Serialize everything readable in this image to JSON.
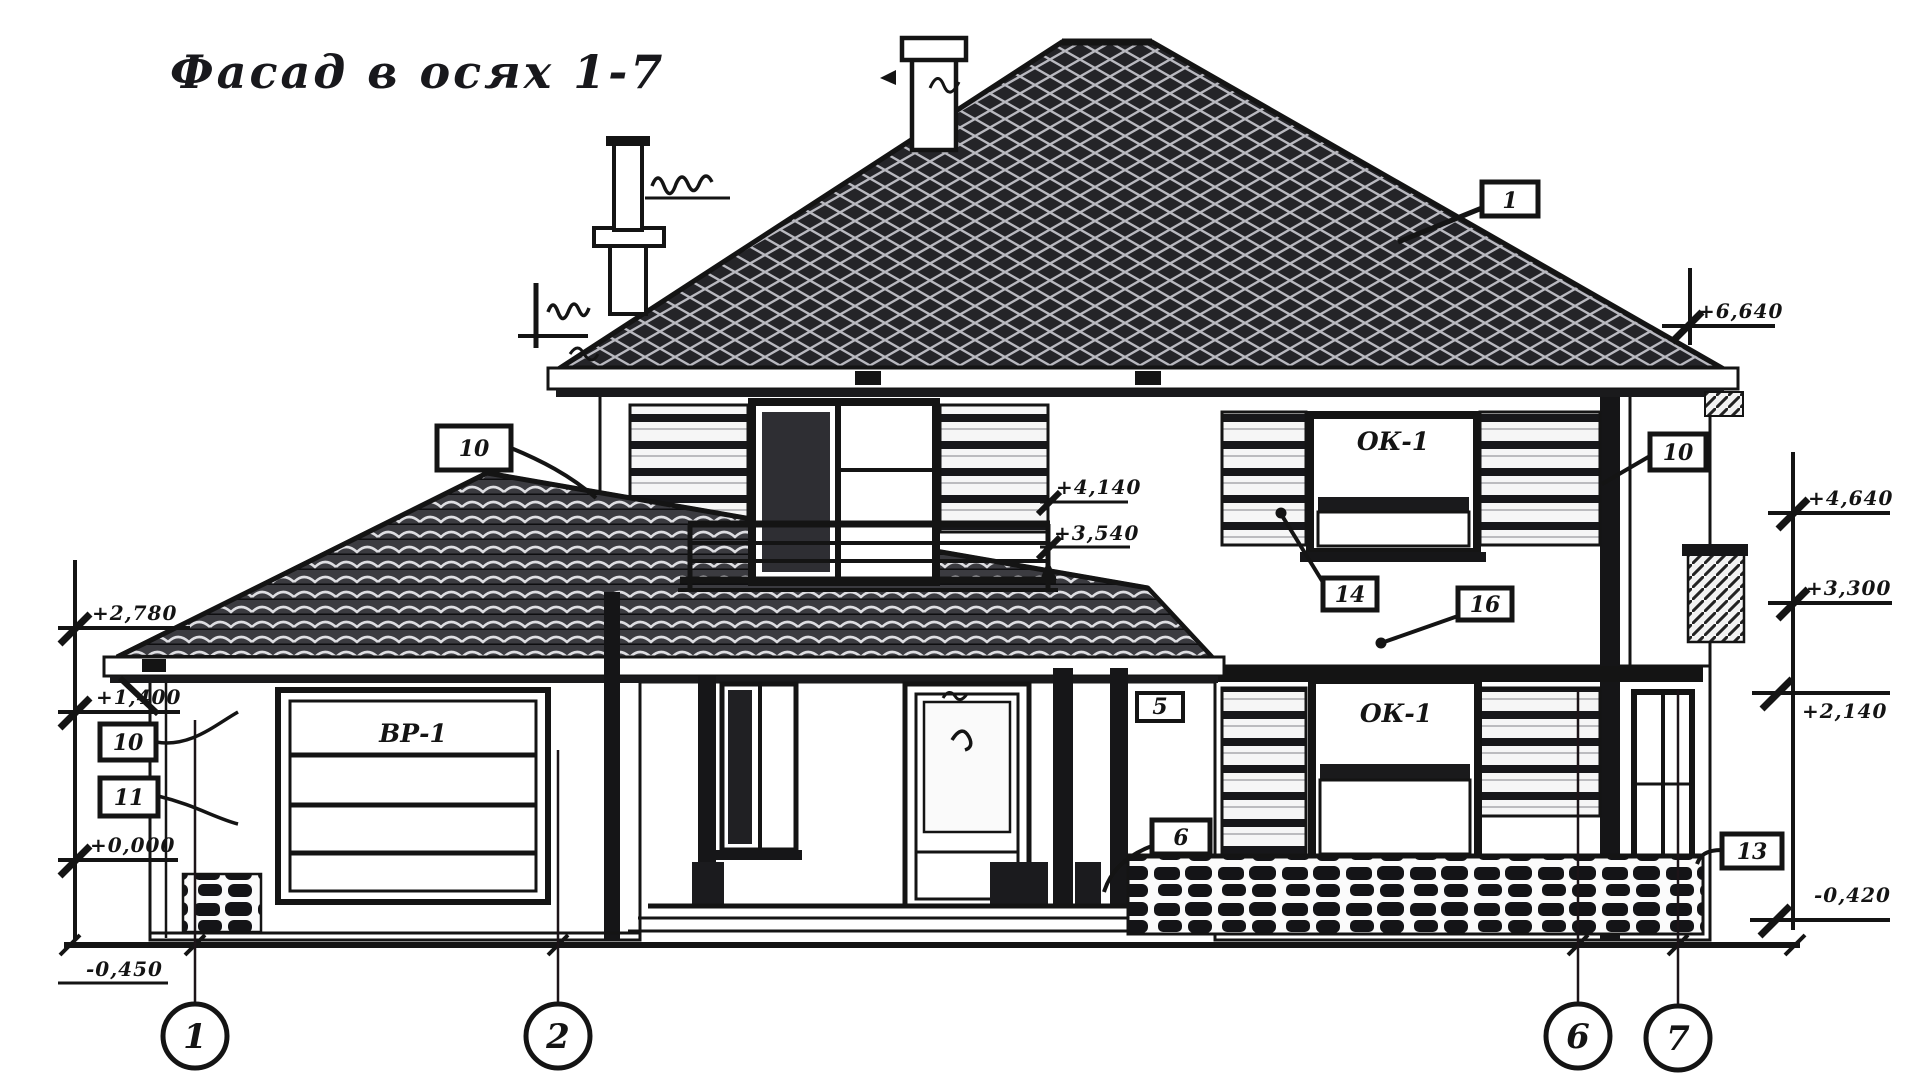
{
  "title": "Фасад в осях 1-7",
  "axis_markers": [
    "1",
    "2",
    "6",
    "7"
  ],
  "window_labels": {
    "second_floor_right": "ОК-1",
    "first_floor_right": "ОК-1"
  },
  "garage_door_label": "ВР-1",
  "callouts": {
    "roof": "1",
    "lower_roof": "10",
    "right_upper": "10",
    "left_upper": "10",
    "left_lower": "11",
    "mid_upper": "14",
    "mid_lower": "16",
    "porch_beam": "5",
    "stone_base": "6",
    "right_corner": "13"
  },
  "elevations": {
    "left": [
      "+2,780",
      "+1,400",
      "+0,000",
      "-0,450"
    ],
    "mid": [
      "+4,140",
      "+3,540"
    ],
    "right_eave": "+6,640",
    "right": [
      "+4,640",
      "+3,300",
      "+2,140",
      "-0,420"
    ]
  },
  "colors": {
    "ink": "#141414",
    "roof_fill": "#242428",
    "paper": "#ffffff"
  }
}
